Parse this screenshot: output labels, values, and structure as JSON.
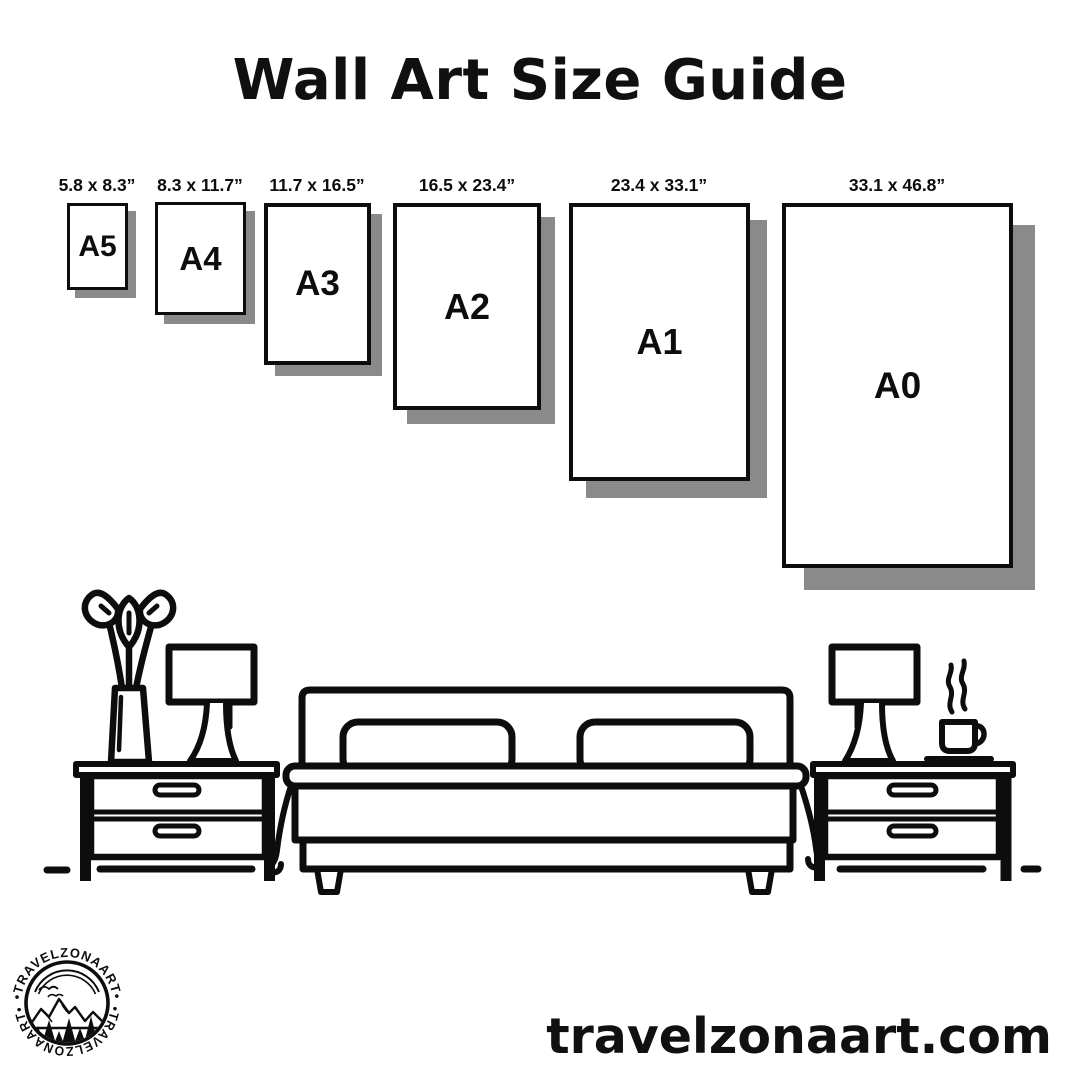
{
  "title": "Wall Art Size Guide",
  "sizes": [
    {
      "code": "A5",
      "dimensions": "5.8 x 8.3”"
    },
    {
      "code": "A4",
      "dimensions": "8.3 x 11.7”"
    },
    {
      "code": "A3",
      "dimensions": "11.7 x 16.5”"
    },
    {
      "code": "A2",
      "dimensions": "16.5 x 23.4”"
    },
    {
      "code": "A1",
      "dimensions": "23.4 x 33.1”"
    },
    {
      "code": "A0",
      "dimensions": "33.1 x 46.8”"
    }
  ],
  "footer": {
    "website": "travelzonaart.com"
  },
  "logo": {
    "brand": "TRAVELZONAART",
    "ring_text_top": "•TRAVELZONAART•",
    "ring_text_bottom": "•TRAVELZONAART•"
  },
  "colors": {
    "ink": "#0d0d0d",
    "shadow": "#8a8a8a",
    "background": "#ffffff"
  }
}
